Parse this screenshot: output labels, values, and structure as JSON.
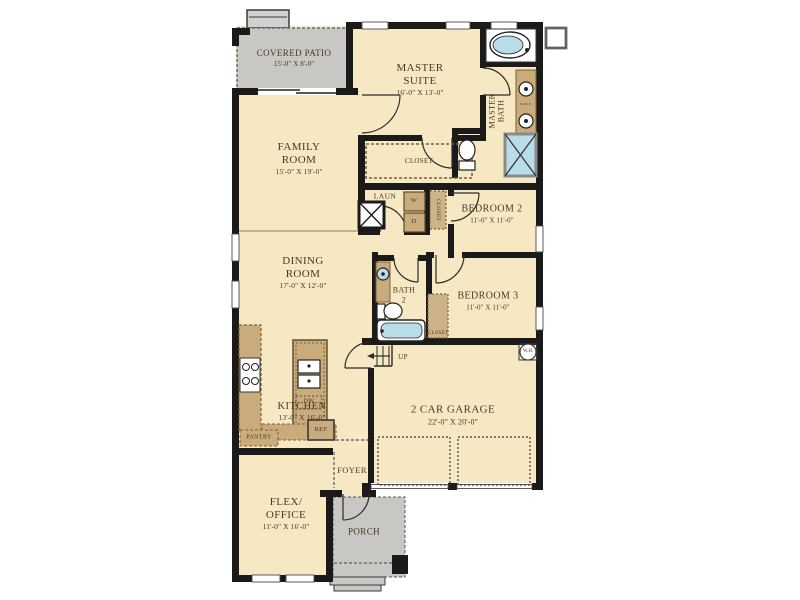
{
  "plan": {
    "covered_patio": {
      "name": "COVERED PATIO",
      "dims": "15'-0\" X 8'-0\""
    },
    "master_suite": {
      "name": "MASTER SUITE",
      "dims": "16'-0\" X 13'-0\""
    },
    "master_bath": {
      "name": "MASTER BATH"
    },
    "family_room": {
      "name": "FAMILY ROOM",
      "dims": "15'-0\" X 19'-0\""
    },
    "master_closet": {
      "name": "CLOSET"
    },
    "laundry": {
      "name": "LAUN",
      "washer": "W",
      "dryer": "D"
    },
    "bedroom2_closet": {
      "name": "CLOSET"
    },
    "bedroom2": {
      "name": "BEDROOM 2",
      "dims": "11'-0\" X 11'-0\""
    },
    "dining_room": {
      "name": "DINING ROOM",
      "dims": "17'-0\" X 12'-0\""
    },
    "bath2": {
      "name": "BATH",
      "number": "2"
    },
    "bedroom3": {
      "name": "BEDROOM 3",
      "dims": "11'-0\" X 11'-0\""
    },
    "bedroom3_closet": {
      "name": "CLOSET"
    },
    "stairs": {
      "label": "UP"
    },
    "kitchen": {
      "name": "KITCHEN",
      "dims": "13'-0\" X 16'-0\""
    },
    "pantry": {
      "name": "PANTRY"
    },
    "appliances": {
      "refrigerator": "REF",
      "dishwasher": "DW",
      "water_heater": "W.H."
    },
    "garage": {
      "name": "2 CAR GARAGE",
      "dims": "22'-0\" X 20'-0\""
    },
    "foyer": {
      "name": "FOYER"
    },
    "flex_office": {
      "name": "FLEX/ OFFICE",
      "dims": "11'-0\" X 16'-0\""
    },
    "porch": {
      "name": "PORCH"
    }
  },
  "colors": {
    "floor": "#f6e8c3",
    "outdoor": "#c8c7c3",
    "wall": "#1a1a1a",
    "cabinet": "#c9ab7c",
    "water": "#b9dce9",
    "text": "#473921"
  }
}
